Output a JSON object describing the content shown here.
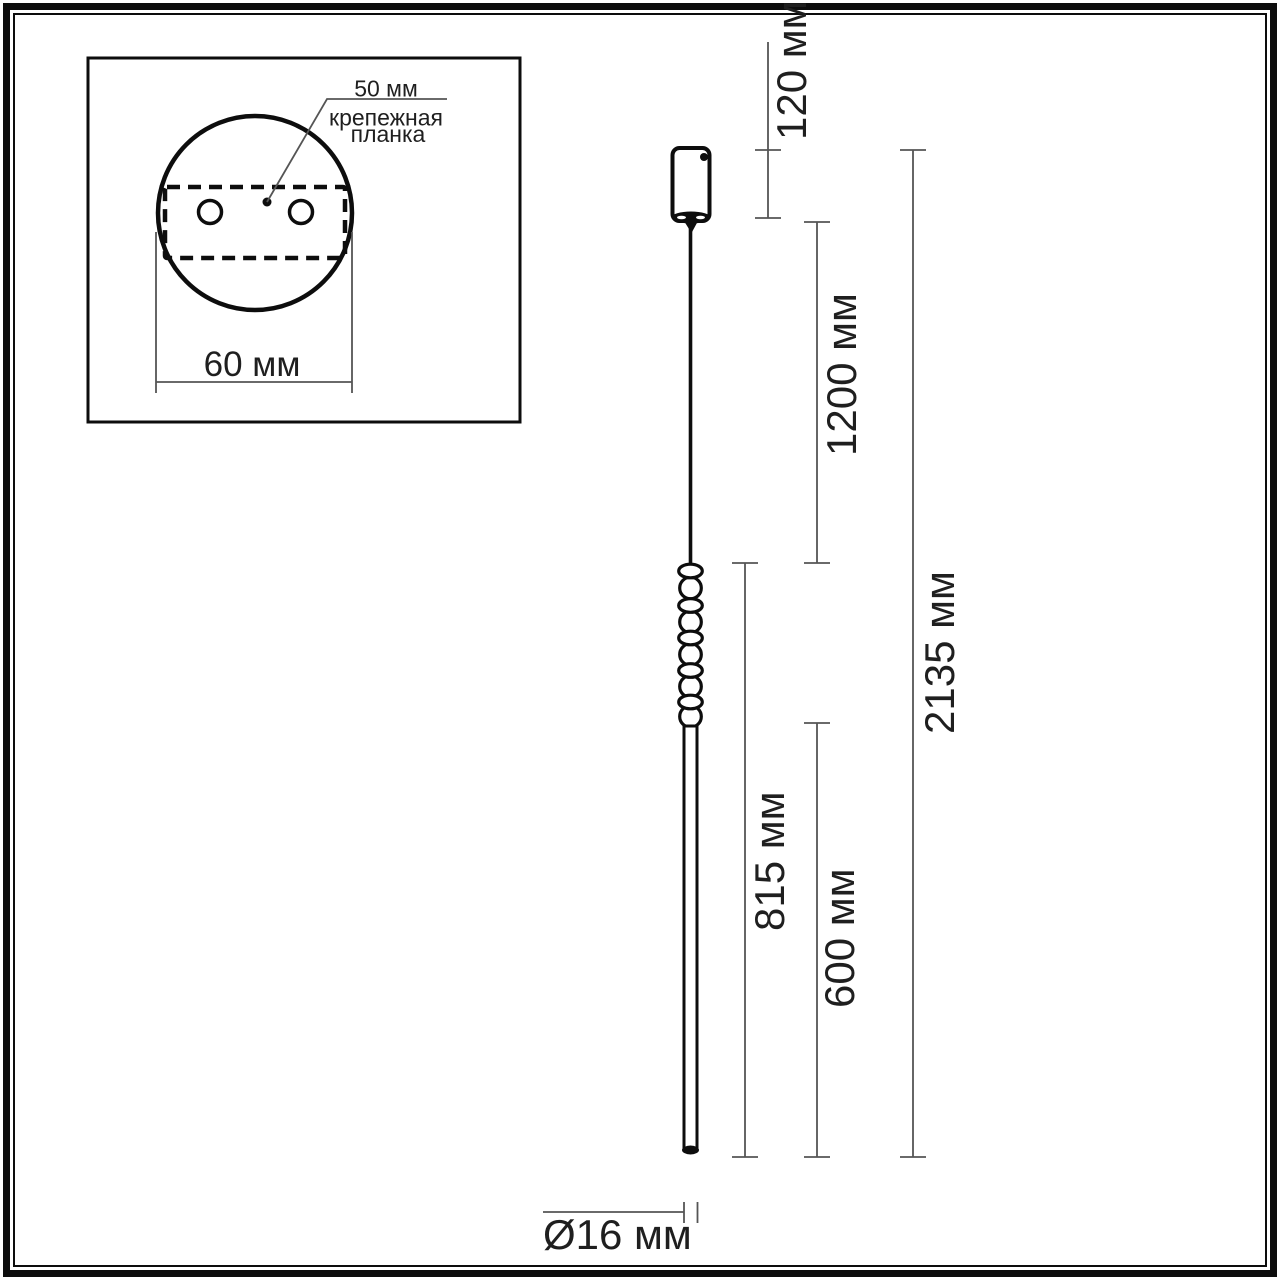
{
  "colors": {
    "ink": "#0d0d0d",
    "dim": "#555555",
    "text": "#1f1f1f",
    "background": "#ffffff"
  },
  "inset": {
    "labels": {
      "plate_width": "50 мм",
      "plate_name_line1": "крепежная",
      "plate_name_line2": "планка",
      "base_diameter": "60 мм"
    }
  },
  "drawing": {
    "labels": {
      "canopy_height": "120 мм",
      "suspension_length": "1200 мм",
      "total_length": "2135 мм",
      "fixture_length": "815 мм",
      "tube_length": "600 мм",
      "tube_diameter": "Ø16 мм"
    }
  }
}
